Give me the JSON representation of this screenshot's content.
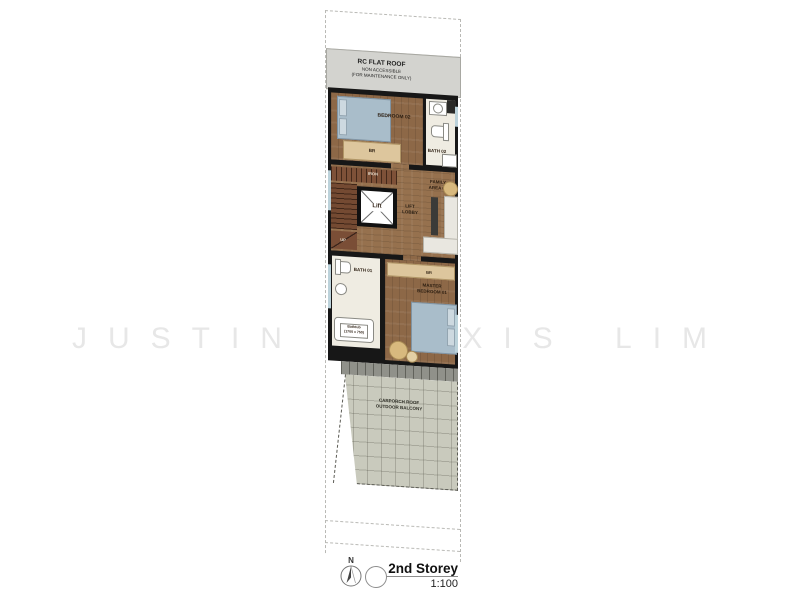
{
  "watermark": "JUSTIN ALEXIS LIM",
  "roof": {
    "line1": "RC FLAT ROOF",
    "line2": "NON ACCESSIBLE",
    "line3": "(FOR MAINTENANCE ONLY)"
  },
  "rooms": {
    "bedroom02": "BEDROOM 02",
    "bedroom02_wardrobe": "BR",
    "bath02": "BATH 02",
    "iron": "IRON",
    "lift": "Lift",
    "lobby_line1": "LIFT",
    "lobby_line2": "LOBBY",
    "family_line1": "FAMILY",
    "family_line2": "AREA 02",
    "up": "UP",
    "bath01": "BATH 01",
    "bathtub_line1": "Bathtub",
    "bathtub_line2": "(1700 x 750)",
    "master_line1": "MASTER",
    "master_line2": "BEDROOM 01",
    "master_wardrobe": "BR",
    "carporch_line1": "CARPORCH ROOF",
    "carporch_line2": "OUTDOOR BALCONY"
  },
  "titleblock": {
    "north": "N",
    "title": "2nd Storey",
    "scale": "1:100"
  },
  "colors": {
    "wood_floor": "#8d6847",
    "wall": "#171717",
    "bed": "#a9bdca",
    "wardrobe_tan": "#ddc69d",
    "bath_floor": "#efece2",
    "roof_gray": "#d3d3cf",
    "carporch_gray": "#c9cabd",
    "watermark_gray": "#e7e7e7"
  }
}
